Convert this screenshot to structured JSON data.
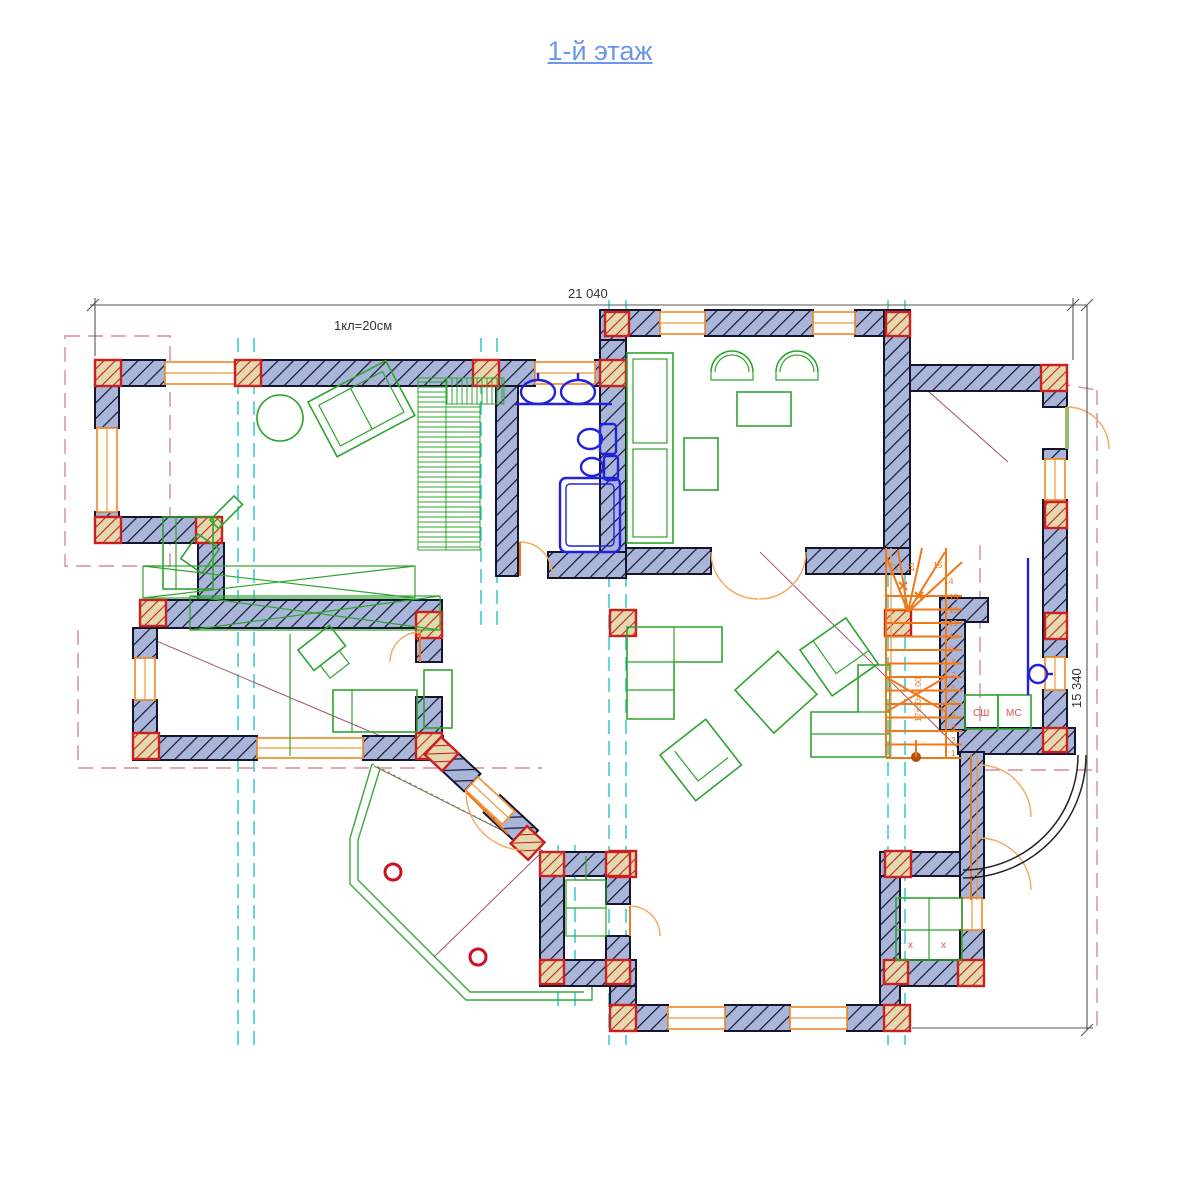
{
  "title": {
    "text": "1-й этаж"
  },
  "annotations": {
    "scale_note": "1кл=20см",
    "dim_width": "21 040",
    "dim_height": "15 340",
    "stair_note": "17х30=3.00"
  },
  "labels": {
    "stair_closet_1": "СШ",
    "stair_closet_2": "МС",
    "closet_x": "х"
  },
  "stairs": {
    "numbers": [
      "1",
      "2",
      "3",
      "4",
      "5",
      "6",
      "7",
      "8",
      "9",
      "10",
      "11",
      "12",
      "13",
      "14",
      "15",
      "16",
      "17"
    ]
  },
  "colors": {
    "wall_fill": "#a9b6da",
    "column_red": "#cc2020",
    "furniture_green": "#2ea42e",
    "plumbing_blue": "#2222dd",
    "stairs_orange": "#f07818",
    "axis_cyan": "#35c8cc",
    "roof_dashed_pink": "#d98a9a",
    "window_orange": "#f0963c",
    "title_blue": "#6b96e9"
  }
}
